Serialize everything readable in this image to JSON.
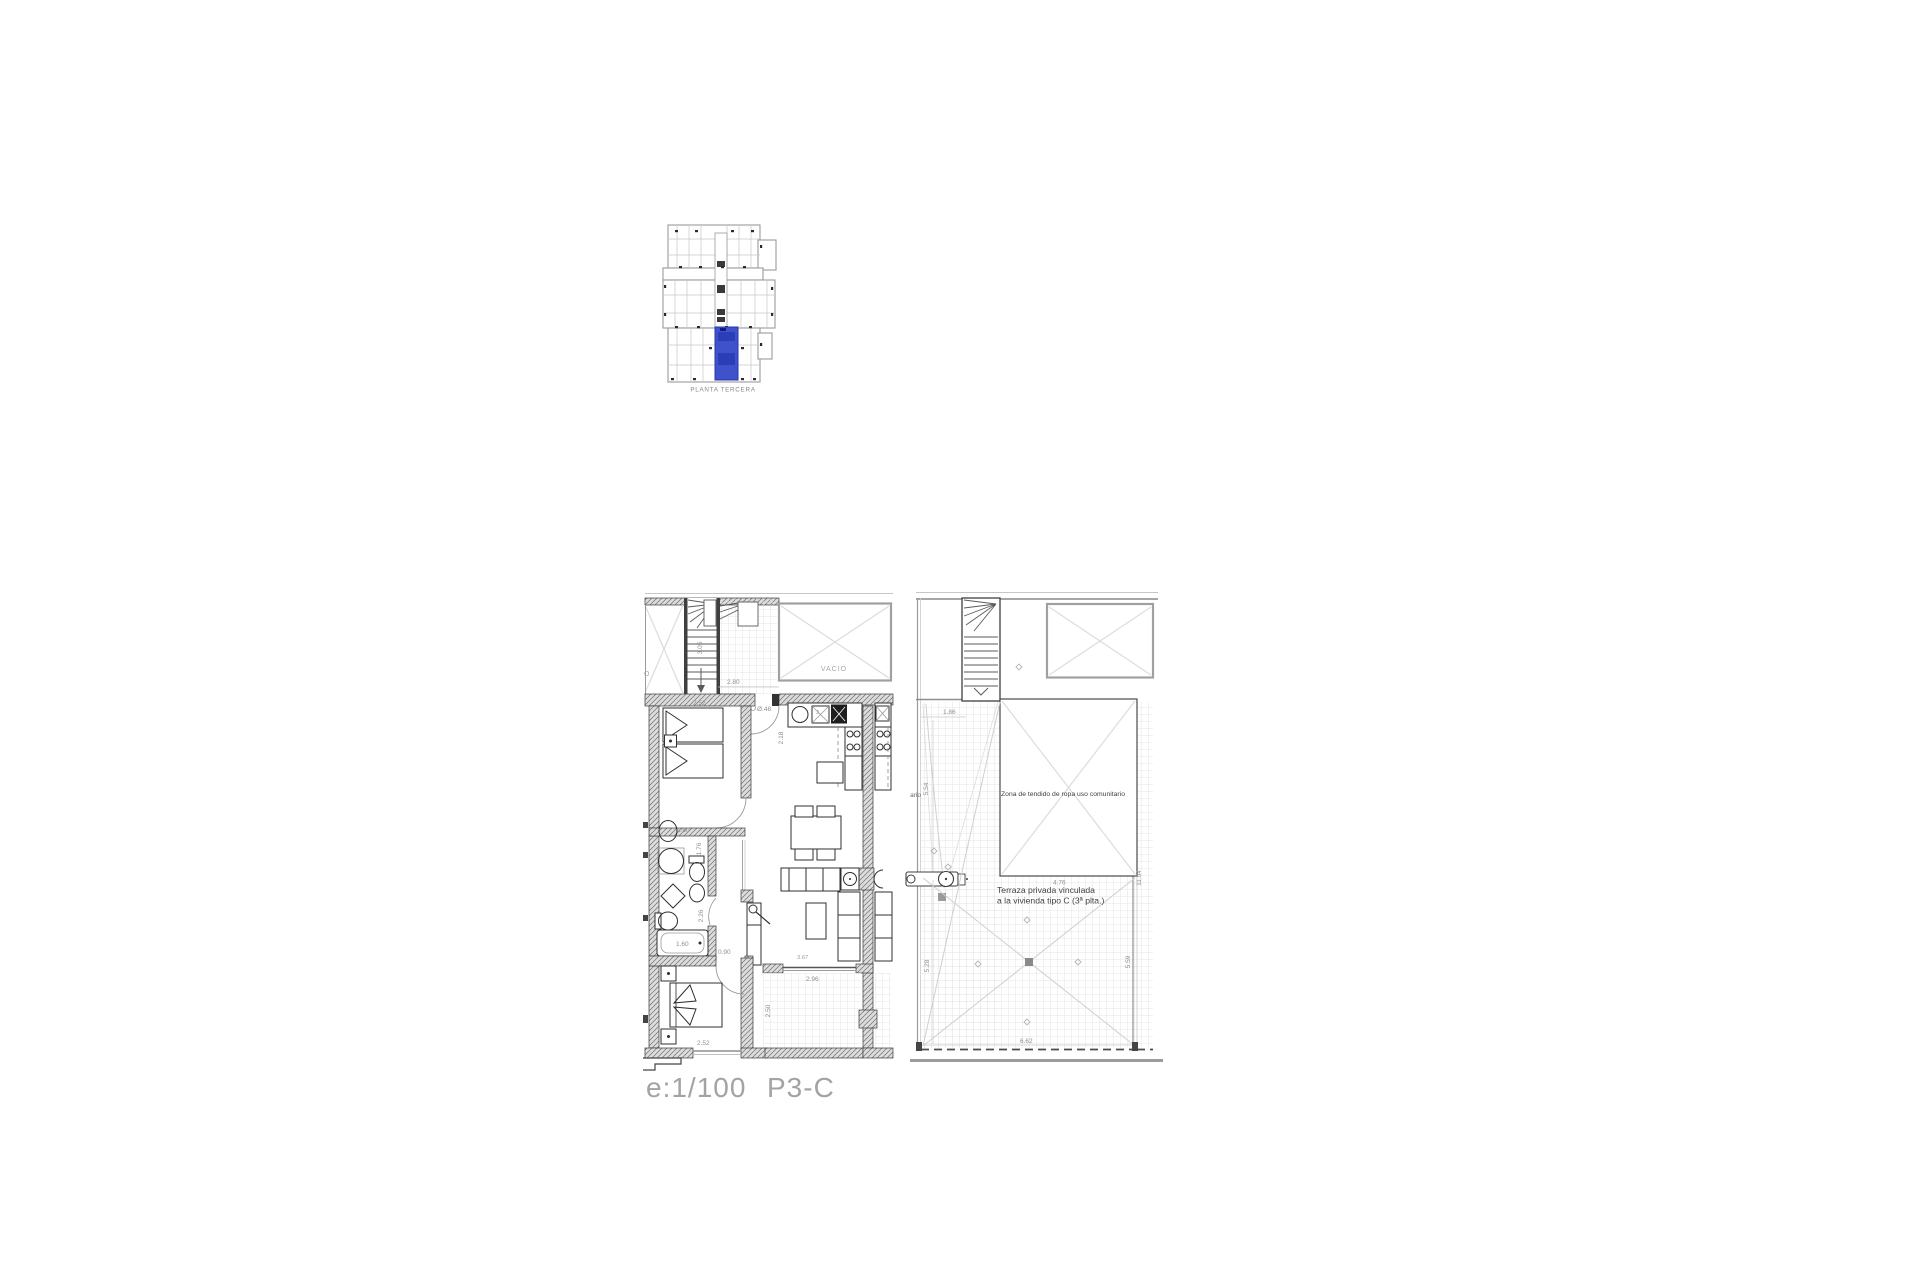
{
  "colors": {
    "highlight_blue": "#3f51cb",
    "highlight_blue_dark": "#2c3db8",
    "wall_dark": "#3a3a3a",
    "line_light": "#c9c9c9",
    "dim_text": "#8f8f8f",
    "label_text": "#3f3f3f",
    "footer_text": "#a3a3a3"
  },
  "overview": {
    "caption": "PLANTA TERCERA"
  },
  "unit_plan": {
    "labels": {
      "vacio": "VACIO",
      "void_fragment": "O",
      "column_dim": "Ø.48",
      "sink_dim": "2."
    },
    "dims": {
      "landing_width": "2.80",
      "stair_length": "3.05",
      "bedroom1_width": "2.52",
      "hall_depth": "2.18",
      "vanity": "1.60",
      "shower_side": "1.76",
      "bath_inner": "2.26",
      "bathtub": "1.60",
      "door_width": "0.90",
      "sofa_width": "3.67",
      "bedroom2_width": "2.52",
      "terrace_width": "2.96",
      "terrace_depth": "2.50"
    }
  },
  "roof_plan": {
    "labels": {
      "laundry": "Zona de tendido de ropa  uso comunitario",
      "terrace_line1": "Terraza privada vinculada",
      "terrace_line2": "a la vivienda tipo C (3ª plta.)",
      "strip_fragment": "ario"
    },
    "dims": {
      "strip_width": "1.86",
      "strip_height": "5.54",
      "terrace_top": "4.76",
      "terrace_left": "5.28",
      "terrace_right": "5.59",
      "terrace_bottom": "6.62",
      "overall_right": "11.04"
    }
  },
  "footer": {
    "scale": "e:1/100",
    "code": "P3-C"
  }
}
